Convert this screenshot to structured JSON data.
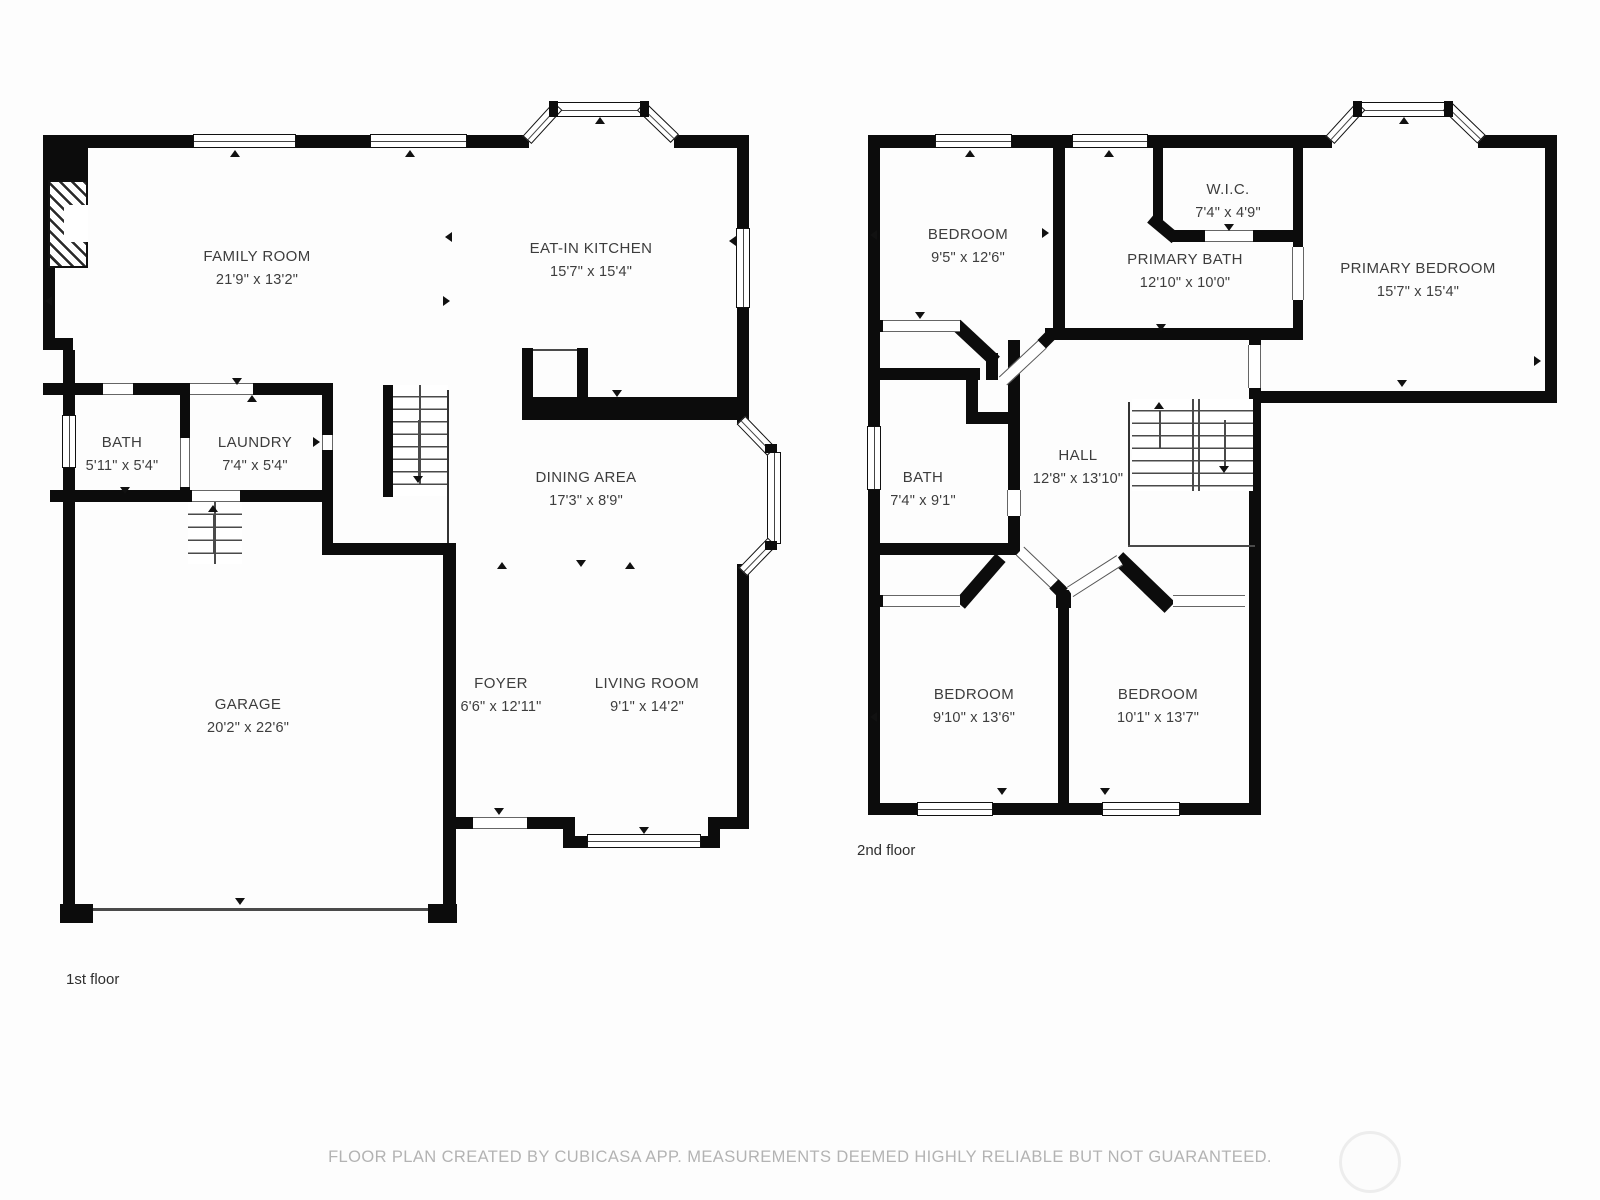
{
  "page": {
    "footer": "FLOOR PLAN CREATED BY CUBICASA APP. MEASUREMENTS DEEMED HIGHLY RELIABLE BUT NOT GUARANTEED.",
    "background": "#fdfdfd"
  },
  "colors": {
    "wall": "#0c0c0c",
    "label_text": "#3d3d3d",
    "footer_text": "#b3b3b3"
  },
  "floors": [
    {
      "label": "1st floor",
      "rooms": [
        {
          "name": "FAMILY ROOM",
          "dims": "21'9\" x 13'2\""
        },
        {
          "name": "EAT-IN KITCHEN",
          "dims": "15'7\" x 15'4\""
        },
        {
          "name": "BATH",
          "dims": "5'11\" x 5'4\""
        },
        {
          "name": "LAUNDRY",
          "dims": "7'4\" x 5'4\""
        },
        {
          "name": "DINING AREA",
          "dims": "17'3\" x 8'9\""
        },
        {
          "name": "GARAGE",
          "dims": "20'2\" x 22'6\""
        },
        {
          "name": "FOYER",
          "dims": "6'6\" x 12'11\""
        },
        {
          "name": "LIVING ROOM",
          "dims": "9'1\" x 14'2\""
        }
      ]
    },
    {
      "label": "2nd floor",
      "rooms": [
        {
          "name": "BEDROOM",
          "dims": "9'5\" x 12'6\""
        },
        {
          "name": "W.I.C.",
          "dims": "7'4\" x 4'9\""
        },
        {
          "name": "PRIMARY BATH",
          "dims": "12'10\" x 10'0\""
        },
        {
          "name": "PRIMARY BEDROOM",
          "dims": "15'7\" x 15'4\""
        },
        {
          "name": "BATH",
          "dims": "7'4\" x 9'1\""
        },
        {
          "name": "HALL",
          "dims": "12'8\" x 13'10\""
        },
        {
          "name": "BEDROOM",
          "dims": "9'10\" x 13'6\""
        },
        {
          "name": "BEDROOM",
          "dims": "10'1\" x 13'7\""
        }
      ]
    }
  ]
}
